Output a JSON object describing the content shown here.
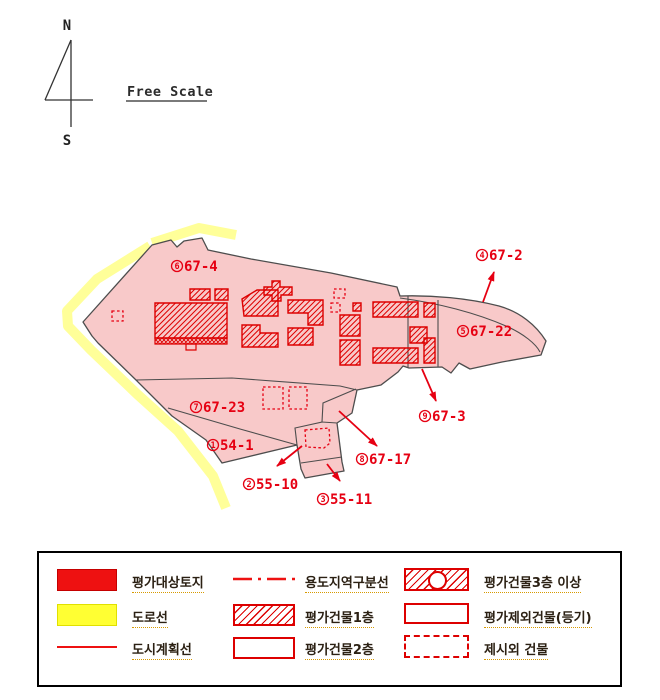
{
  "compass": {
    "north_label": "N",
    "south_label": "S"
  },
  "scale_label": "Free Scale",
  "map": {
    "region_labels": [
      {
        "num": "1",
        "lot": "54-1"
      },
      {
        "num": "2",
        "lot": "55-10"
      },
      {
        "num": "3",
        "lot": "55-11"
      },
      {
        "num": "4",
        "lot": "67-2"
      },
      {
        "num": "5",
        "lot": "67-22"
      },
      {
        "num": "6",
        "lot": "67-4"
      },
      {
        "num": "7",
        "lot": "67-23"
      },
      {
        "num": "8",
        "lot": "67-17"
      },
      {
        "num": "9",
        "lot": "67-3"
      }
    ]
  },
  "legend": {
    "col1": [
      {
        "label": "평가대상토지",
        "type": "red-fill"
      },
      {
        "label": "도로선",
        "type": "yellow-fill"
      },
      {
        "label": "도시계획선",
        "type": "red-line"
      }
    ],
    "col2": [
      {
        "label": "용도지역구분선",
        "type": "dash-dot-line"
      },
      {
        "label": "평가건물1층",
        "type": "diagonal-hatch"
      },
      {
        "label": "평가건물2층",
        "type": "cross-hatch"
      }
    ],
    "col3": [
      {
        "label": "평가건물3층 이상",
        "type": "diagonal-hatch-circle"
      },
      {
        "label": "평가제외건물(등기)",
        "type": "empty-rect"
      },
      {
        "label": "제시외 건물",
        "type": "dashed-rect"
      }
    ]
  },
  "colors": {
    "parcel_fill": "#f8c9c9",
    "road_yellow": "#ffff99",
    "building_red": "#dd0000",
    "label_red": "#e60012",
    "outline_gray": "#4d4d4d",
    "legend_red": "#ee1111",
    "legend_yellow": "#ffff33"
  }
}
